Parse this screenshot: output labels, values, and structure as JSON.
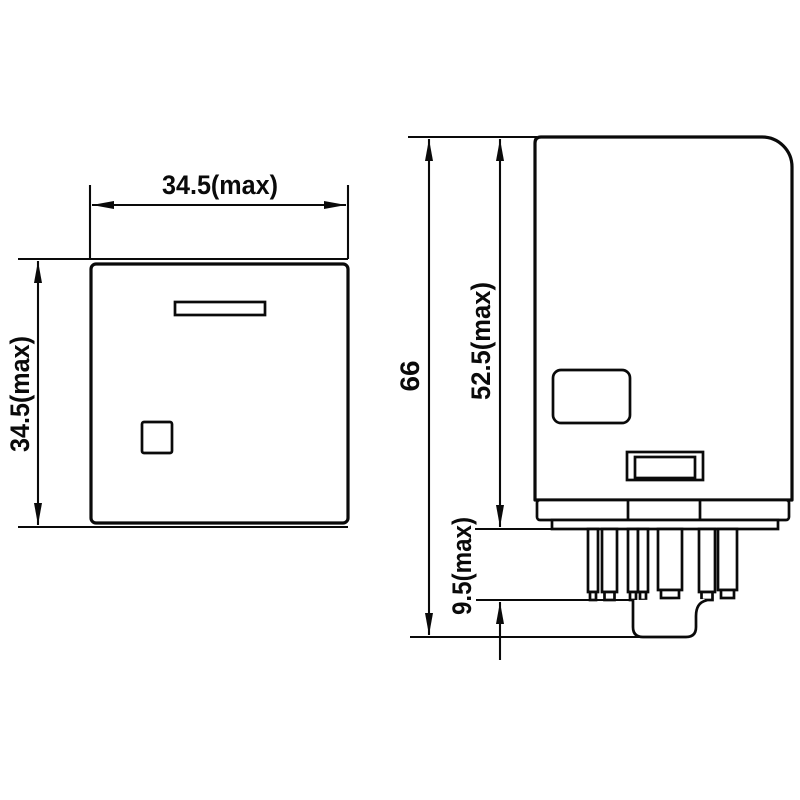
{
  "drawing": {
    "background_color": "#ffffff",
    "line_color": "#0a0a0a",
    "front_view": {
      "width_dimension": "34.5(max)",
      "height_dimension": "34.5(max)"
    },
    "side_view": {
      "overall_height_dimension": "66",
      "body_height_dimension": "52.5(max)",
      "pin_length_dimension": "9.5(max)"
    }
  }
}
